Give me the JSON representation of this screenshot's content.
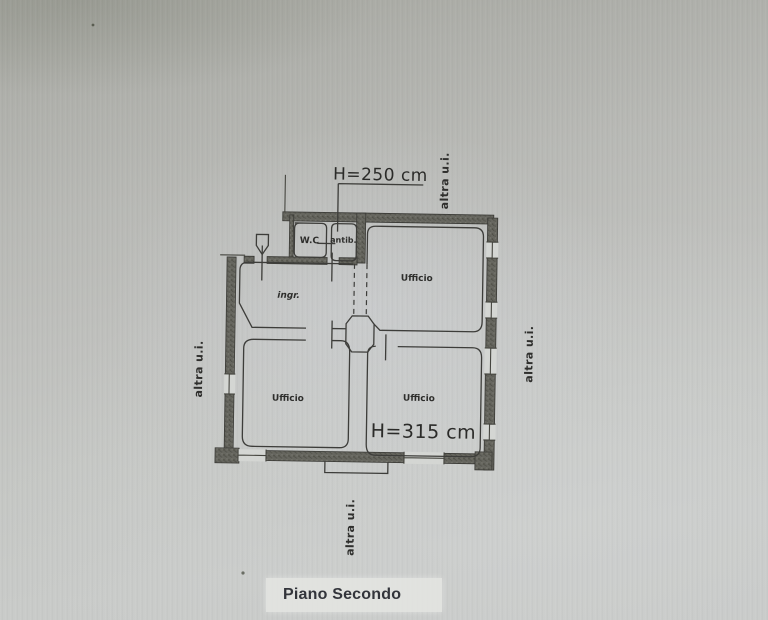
{
  "page": {
    "floor_label": "Piano Secondo"
  },
  "dimensions": {
    "upper": "H=250 cm",
    "lower": "H=315 cm"
  },
  "rooms": {
    "wc": "W.C",
    "antib": "antib.",
    "ingr": "ingr.",
    "ufficio_top_right": "Ufficio",
    "ufficio_bottom_left": "Ufficio",
    "ufficio_bottom_right": "Ufficio"
  },
  "neighbors": {
    "top": "altra u.i.",
    "right": "altra u.i.",
    "left": "altra u.i.",
    "bottom": "altra u.i."
  },
  "colors": {
    "ink": "#2e2e2c",
    "wall_fill": "#66665f",
    "paper_top": "#a6a7a0",
    "paper_bottom": "#c9cbc9",
    "floor_label_bg": "#e6e7e3",
    "floor_label_text": "#33353b"
  }
}
